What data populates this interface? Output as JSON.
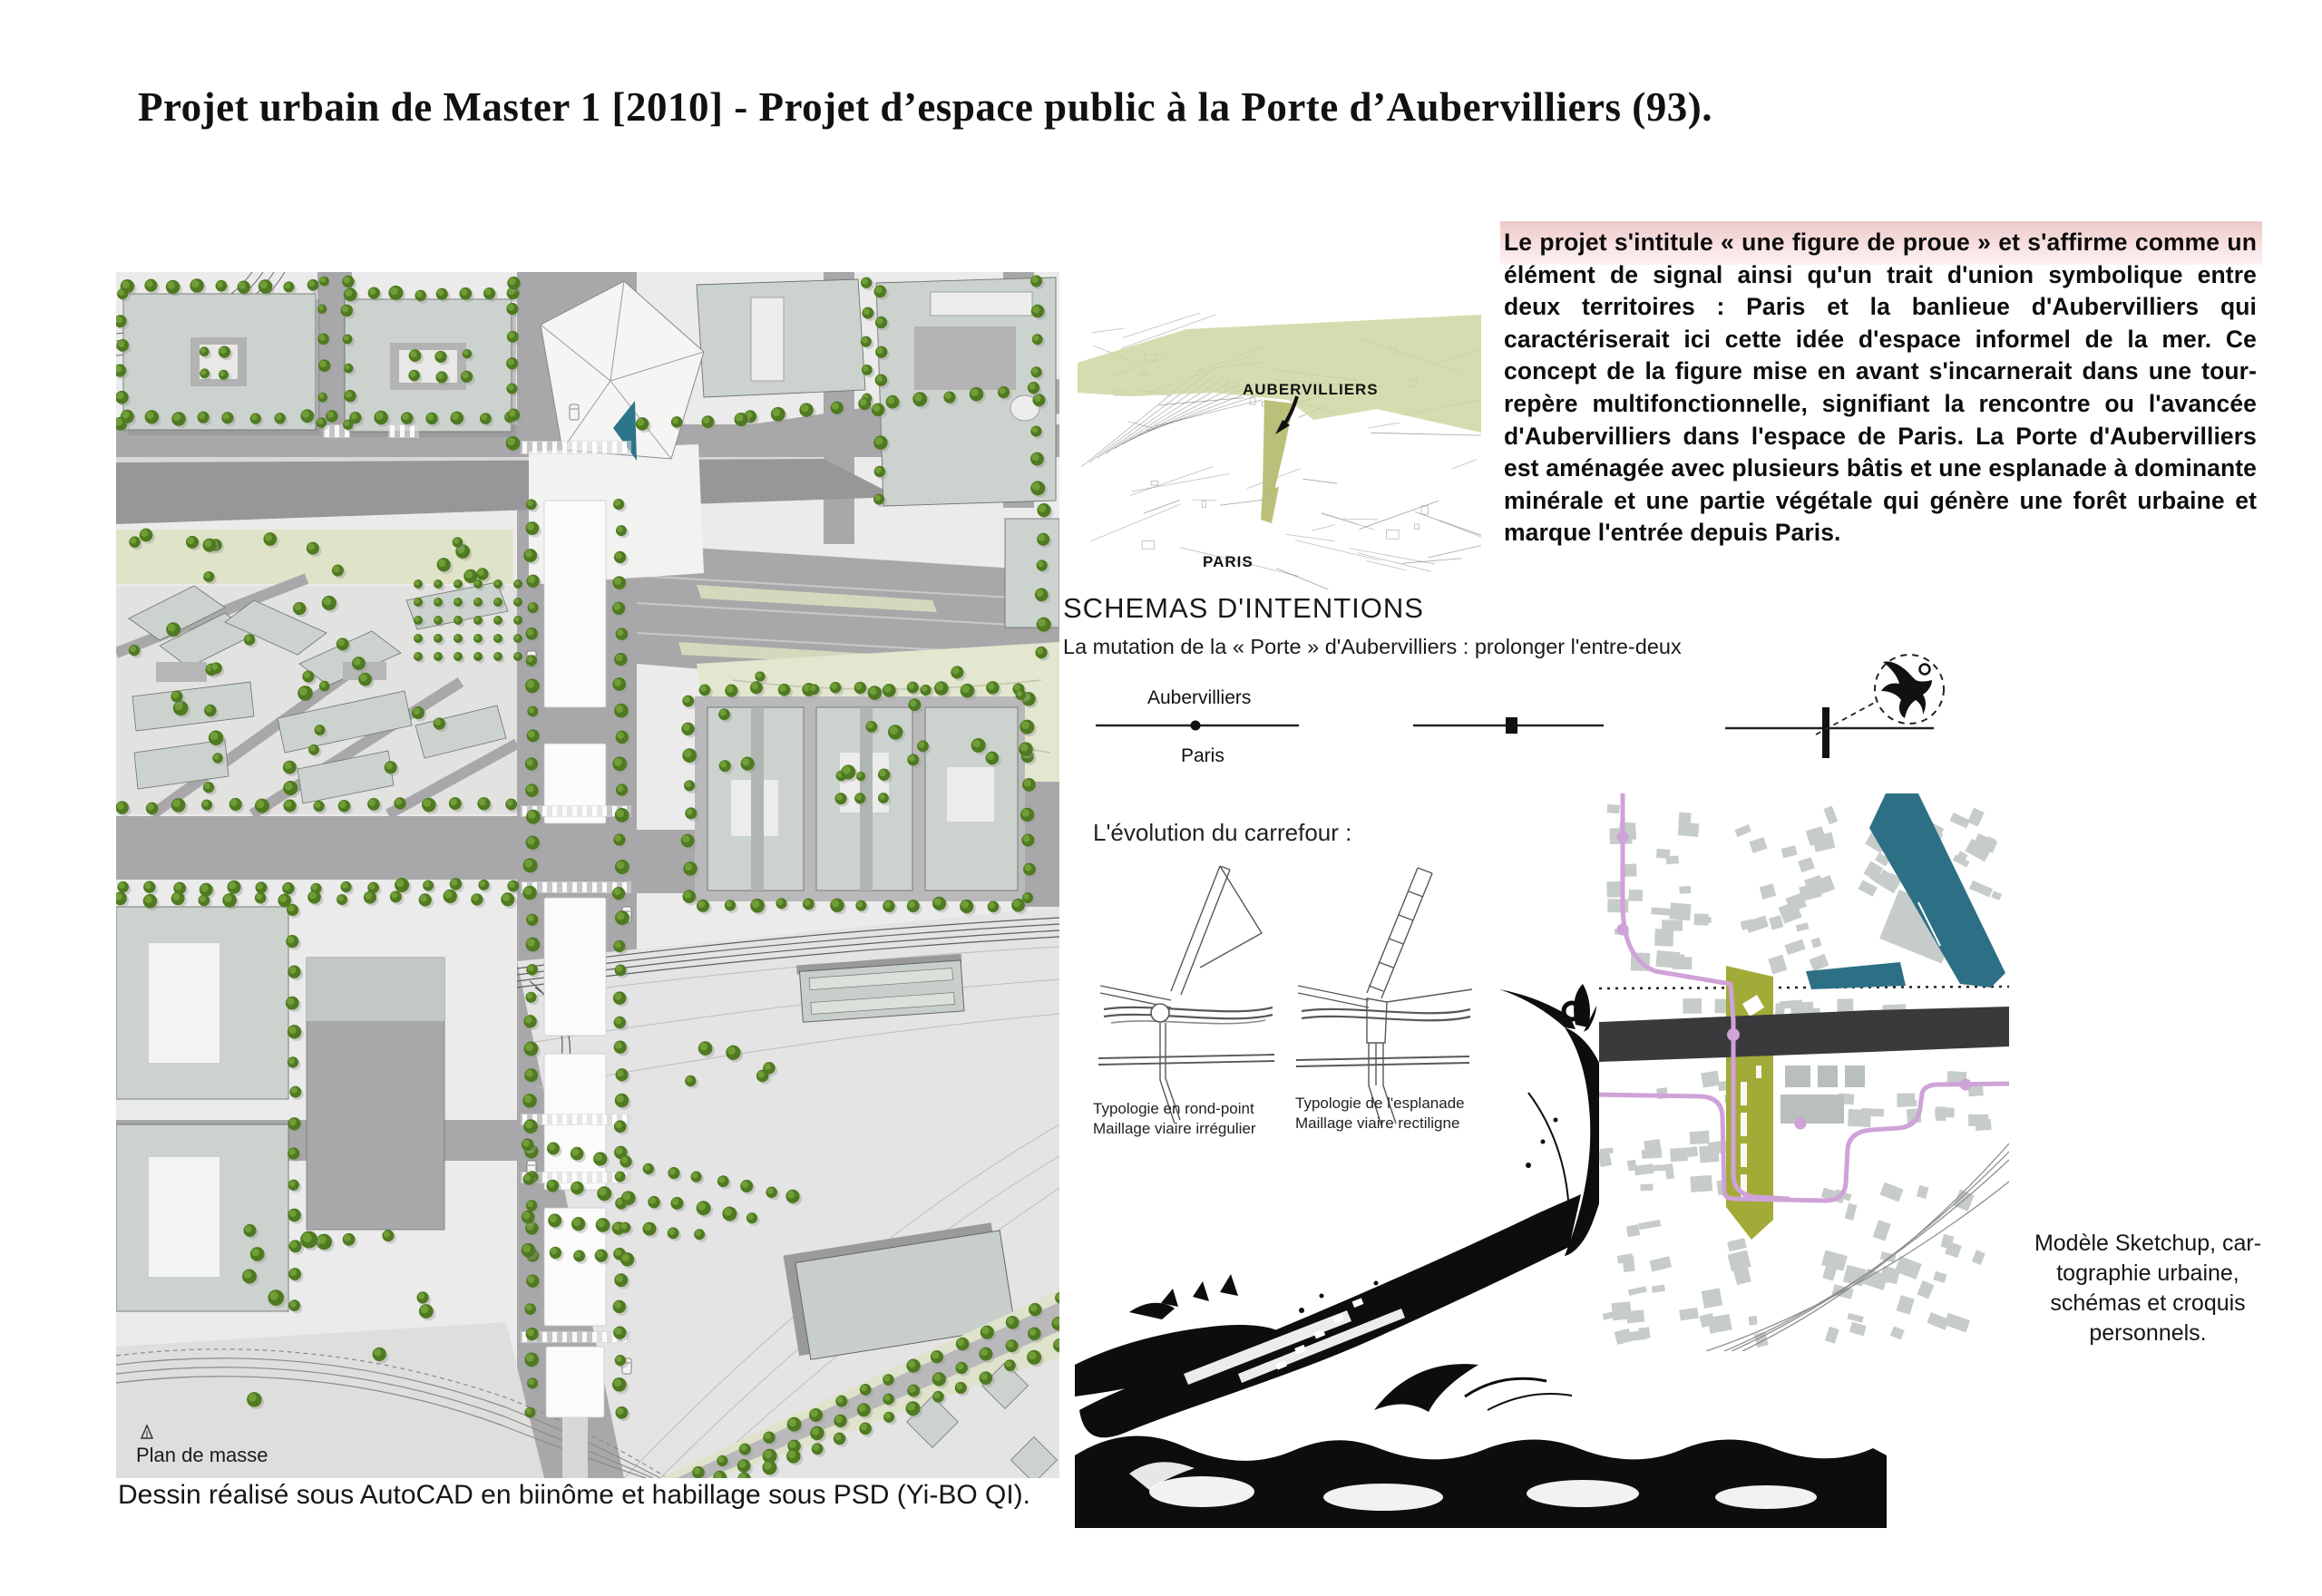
{
  "page": {
    "title": "Projet urbain de Master 1 [2010] - Projet d’espace public à la Porte d’Aubervilliers (93)."
  },
  "colors": {
    "accent_olive": "#a2ab37",
    "context_olive": "#ccd39b",
    "metro_purple": "#cfa2d8",
    "canal_teal": "#2d7086",
    "periph_dark": "#3a3a3d",
    "highlight_pink": "#f6dcdc",
    "tree_green": "#4f7a21",
    "tree_light": "#74a13a",
    "building_sage": "#ccd3ce",
    "road_gray": "#a8a8aa"
  },
  "main_map": {
    "label": "Plan de masse",
    "caption": "Dessin réalisé sous AutoCAD en biinôme et habillage sous PSD (Yi-BO QI)."
  },
  "context_map": {
    "label_top": "AUBERVILLIERS",
    "label_bottom": "PARIS"
  },
  "project_text": {
    "paragraph": "Le projet s'intitule « une figure de proue » et s'affirme comme un élément de signal ainsi qu'un trait d'union symbolique entre deux territoires : Paris et la banlieue d'Aubervilliers qui caractériserait ici cette idée d'espace informel de la mer. Ce concept de la figure mise en avant s'incarnerait dans une tour-repère multifonctionnelle, signifiant la rencontre ou l'avancée d'Aubervilliers dans l'espace de Paris. La Porte d'Aubervilliers est aménagée avec plusieurs bâtis et une esplanade à dominante minérale et une partie végétale qui génère une forêt urbaine et marque l'entrée depuis Paris."
  },
  "schemas": {
    "heading": "SCHEMAS D'INTENTIONS",
    "subheading": "La mutation de la « Porte » d'Aubervilliers : prolonger l'entre-deux",
    "label_top": "Aubervilliers",
    "label_bottom": "Paris"
  },
  "carrefour": {
    "heading": "L'évolution du carrefour :",
    "left_caption_line1": "Typologie en rond-point",
    "left_caption_line2": "Maillage viaire irrégulier",
    "right_caption_line1": "Typologie de l'esplanade",
    "right_caption_line2": "Maillage viaire rectiligne"
  },
  "right_map": {
    "caption": "Modèle Sketchup, car-\ntographie urbaine,\nschémas et croquis\npersonnels."
  }
}
